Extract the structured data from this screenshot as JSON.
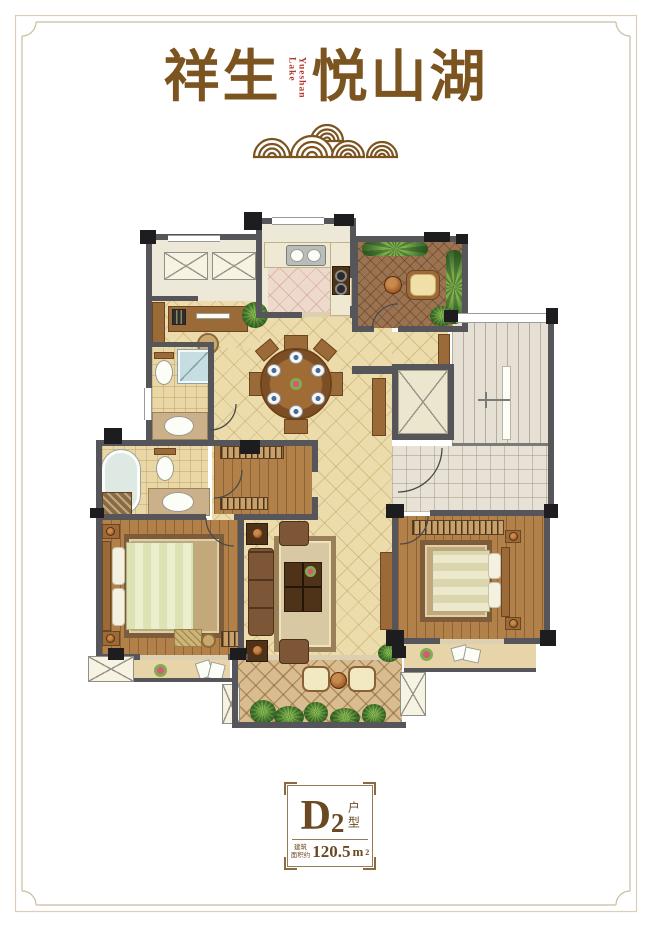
{
  "poster": {
    "brand": {
      "title_left": "祥生",
      "title_right": "悦山湖",
      "title_sub_vertical": "Yueshan Lake"
    },
    "decor": {
      "cloud_motif": "auspicious-clouds"
    },
    "unit_badge": {
      "letter": "D",
      "number": "2",
      "type_label": "户型",
      "area_prefix_line1": "建筑",
      "area_prefix_line2": "面积约",
      "area_value": "120.5",
      "area_unit_base": "m",
      "area_unit_exponent": "2"
    },
    "colors": {
      "title_brown": "#7b5420",
      "accent_red": "#b5382c",
      "frame_line": "#dbcfba",
      "wall_gray": "#55555a",
      "column_black": "#1d1d1f",
      "tile_tan": "#ecdcab",
      "kitchen_tile": "#eedacd",
      "wood_floor": "#b28049",
      "tea_floor": "#9c7350",
      "balcony_floor": "#d9bd90",
      "plant_green": "#5c8f3a"
    }
  }
}
